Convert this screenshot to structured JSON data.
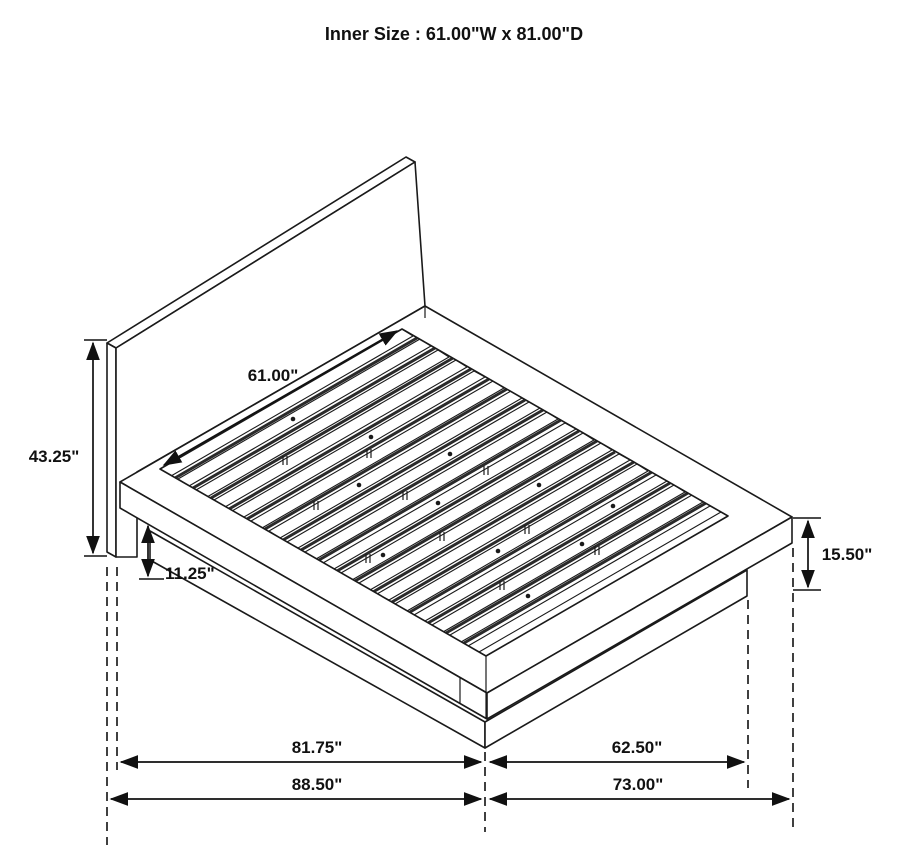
{
  "title": "Inner Size : 61.00\"W x 81.00\"D",
  "colors": {
    "background": "#ffffff",
    "line": "#1a1a1a",
    "text": "#111111"
  },
  "dims": {
    "inner_width": "61.00\"",
    "headboard_height": "43.25\"",
    "base_height": "11.25\"",
    "side_height": "15.50\"",
    "depth_to_headboard_front": "81.75\"",
    "base_width_right": "62.50\"",
    "depth_overall": "88.50\"",
    "frame_width_right": "73.00\""
  }
}
